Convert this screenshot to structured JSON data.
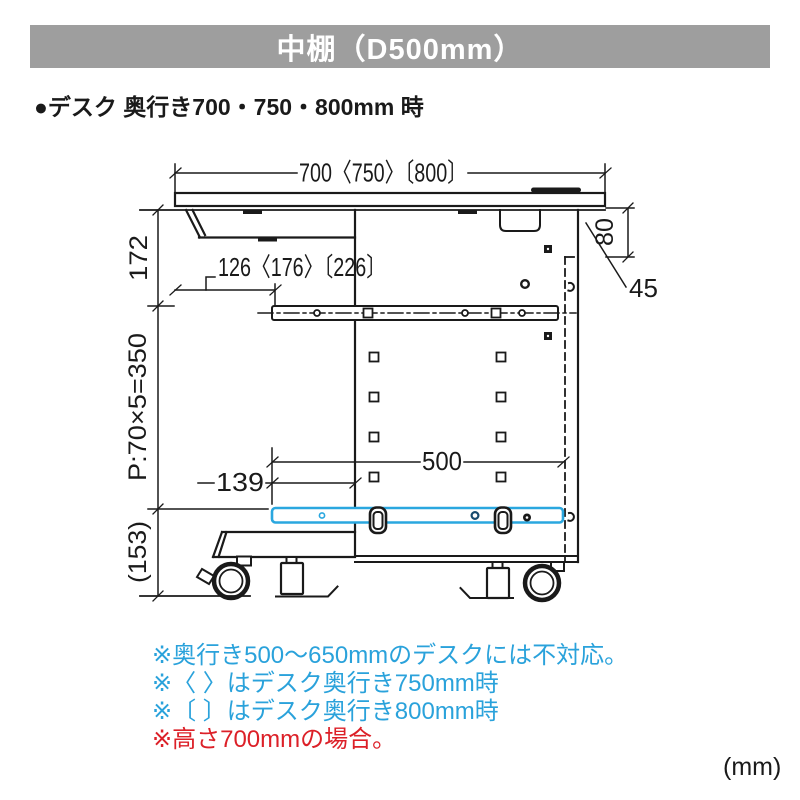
{
  "header": {
    "title": "中棚（D500mm）",
    "bar_color": "#9e9e9e"
  },
  "heading": {
    "text": "●デスク 奥行き700・750・800mm 時"
  },
  "diagram": {
    "line_color": "#1a1a1a",
    "shelf_color": "#2aa7df",
    "dimensions": {
      "top_width": "700〈750〉〔800〕",
      "left_upper": "172",
      "left_pitch": "P:70×5=350",
      "left_lower": "(153)",
      "inset": "126〈176〉〔226〕",
      "right_upper": "80",
      "right_overhang": "45",
      "shelf_depth": "500",
      "shelf_offset": "139"
    }
  },
  "notes": {
    "items": [
      {
        "text": "※奥行き500〜650mmのデスクには不対応。",
        "color": "#2aa2db"
      },
      {
        "text": "※〈 〉はデスク奥行き750mm時",
        "color": "#2aa2db"
      },
      {
        "text": "※〔 〕はデスク奥行き800mm時",
        "color": "#2aa2db"
      },
      {
        "text": "※高さ700mmの場合。",
        "color": "#dc2028"
      }
    ]
  },
  "footer": {
    "unit": "(mm)"
  }
}
